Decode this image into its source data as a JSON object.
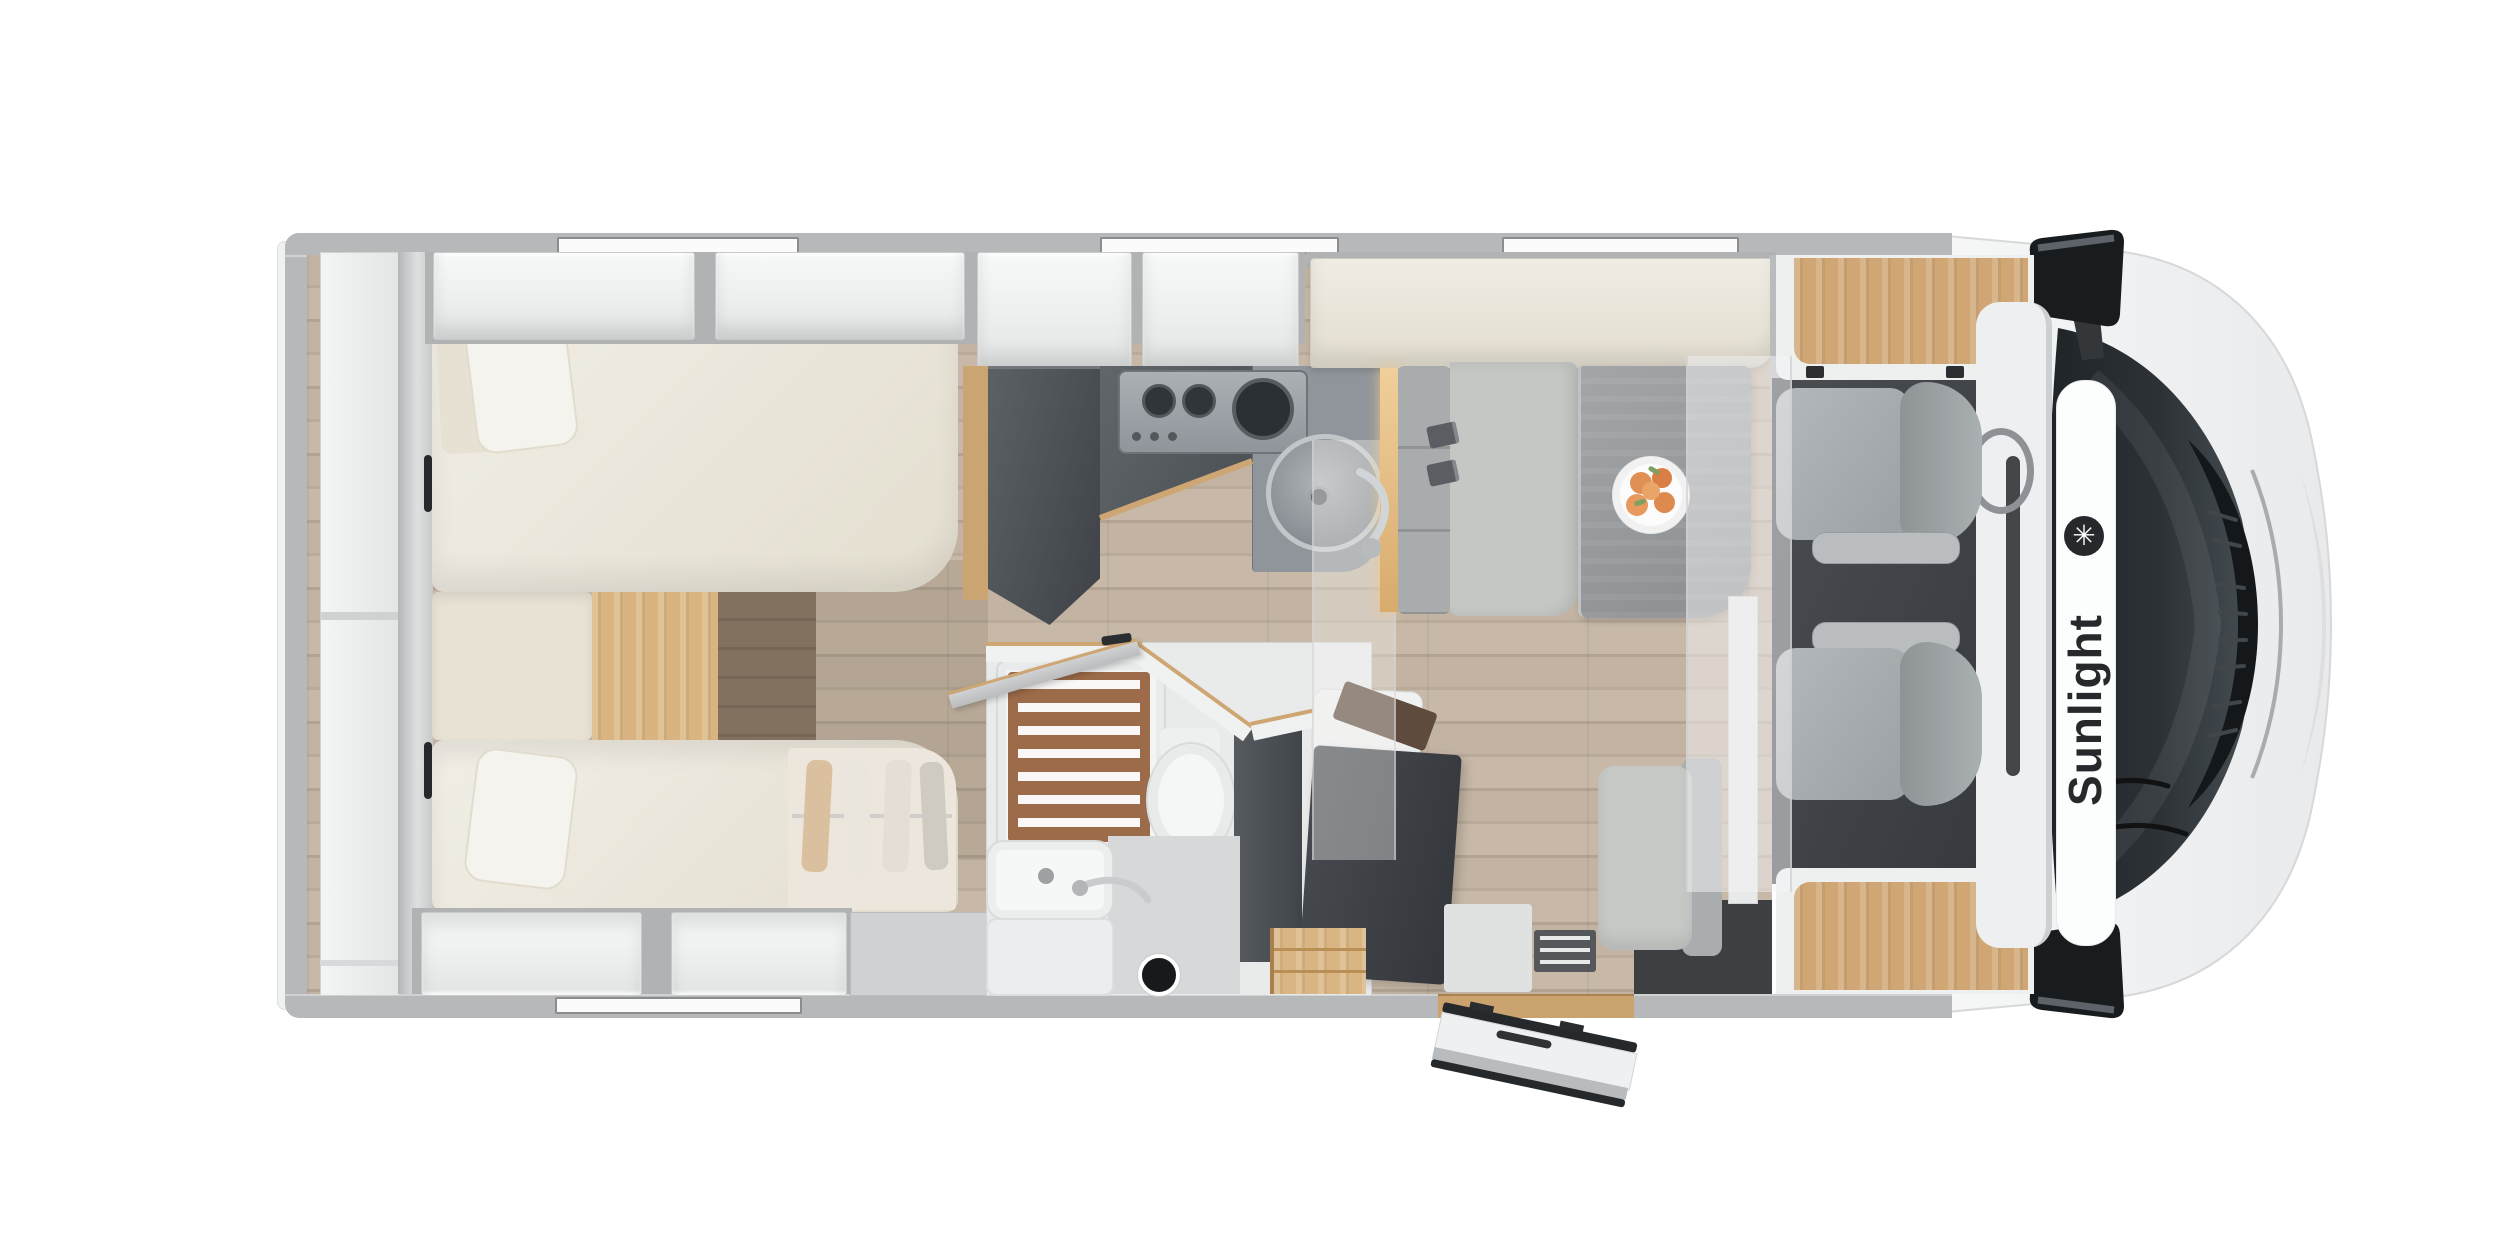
{
  "page": {
    "background": "#ffffff",
    "description": "Top-down 3D cutaway floor plan of a Sunlight semi-integrated motorhome, cab at right"
  },
  "brand": {
    "name": "Sunlight",
    "logo_glyph": "✳"
  },
  "areas": {
    "rear_storage": "Rear storage shelves",
    "wardrobe": "Rear wardrobe",
    "bed_top": "Single bed (top)",
    "bed_bottom": "Single bed (bottom)",
    "bed_step": "Wood step between beds",
    "underbed_wardrobe": "Wardrobe under bed (translucent, hanging clothes)",
    "overhead_lockers": "Overhead lockers",
    "kitchen_tall_unit": "Fridge / tall kitchen unit",
    "kitchen_counter": "Kitchen counter",
    "hob": "3-burner gas hob",
    "kitchen_sink": "Round kitchen sink",
    "bathroom": "Bathroom",
    "shower": "Shower with wooden grate",
    "toilet": "Toilet",
    "washbasin": "Washbasin vanity",
    "swivel_wall": "Swivelling bathroom wall",
    "entry_door": "Entry door (open)",
    "entry_step": "Entry step and landing",
    "dinette_bench": "Travel bench with seatbelts",
    "dinette_table": "Dinette table",
    "fruit_plate": "Plate with fruit",
    "side_seat": "Side seat",
    "cab_seats": "Swivelled driver and passenger seats",
    "dashboard": "Dashboard",
    "steering_wheel": "Steering wheel",
    "windshield": "Windshield",
    "mirrors": "Side mirrors",
    "drop_down_bed": "Drop-down bed over cab (translucent)",
    "roof_windows": "Roof / wall windows"
  },
  "colors": {
    "body_wall": "#b6b8ba",
    "furniture_white": "#f1f2f2",
    "upholstery_cream": "#eae5d8",
    "wood_light": "#d9b480",
    "floor_wood": "#bdb0a1",
    "floor_dark_wood": "#7e6c5d",
    "kitchen_dark": "#4b5055",
    "seat_gray": "#a9adb0",
    "cab_floor": "#3f4347",
    "windshield": "#23282c",
    "shower_wood": "#9c6b49",
    "fruit_accent": "#e08c52",
    "logo_ink": "#26292c"
  }
}
